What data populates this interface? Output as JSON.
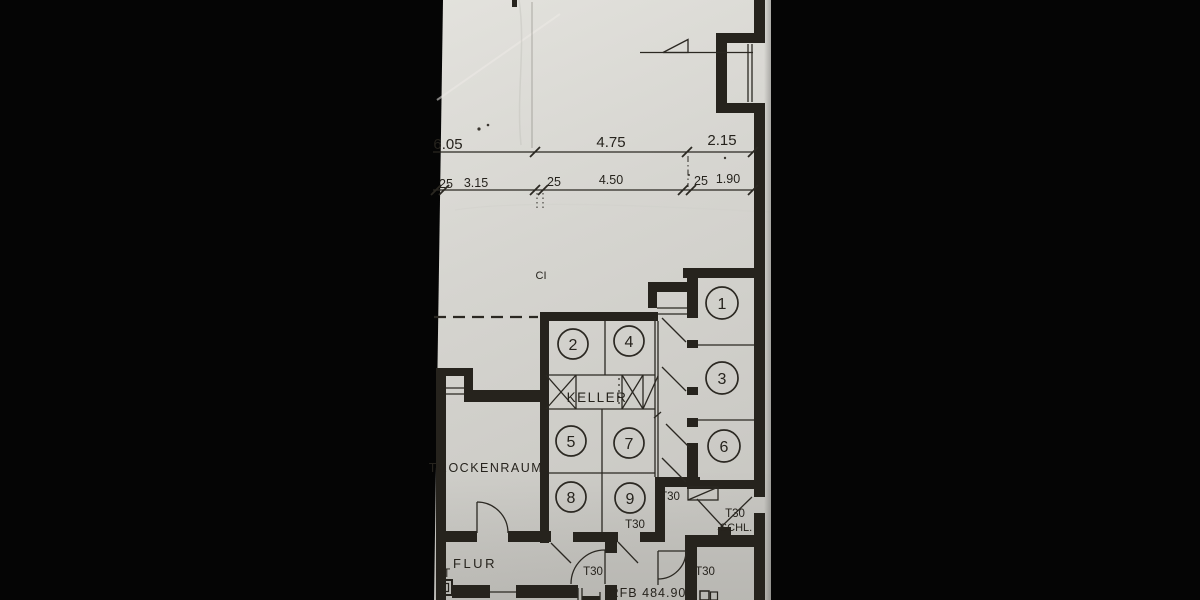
{
  "title": "Scanned basement floor plan (photo with black borders)",
  "colors": {
    "photo_background": "#050505",
    "paper_light": "#e0dfda",
    "paper_mid": "#d5d4cf",
    "paper_dark": "#c7c6c1",
    "ink": "#26231d"
  },
  "dimensions": {
    "row1": [
      "6.05",
      "4.75",
      "2.15"
    ],
    "row2": [
      "25",
      "3.15",
      "25",
      "4.50",
      "25",
      "1.90"
    ]
  },
  "rooms": {
    "trockenraum": "TROCKENRAUM",
    "keller": "KELLER",
    "flur": "FLUR"
  },
  "labels": {
    "ci": "CI",
    "pt": "PT",
    "t30": "T30",
    "schl": "SCHL.",
    "rfb": "RFB 484.90"
  },
  "cells": [
    "1",
    "2",
    "3",
    "4",
    "5",
    "6",
    "7",
    "8",
    "9"
  ]
}
